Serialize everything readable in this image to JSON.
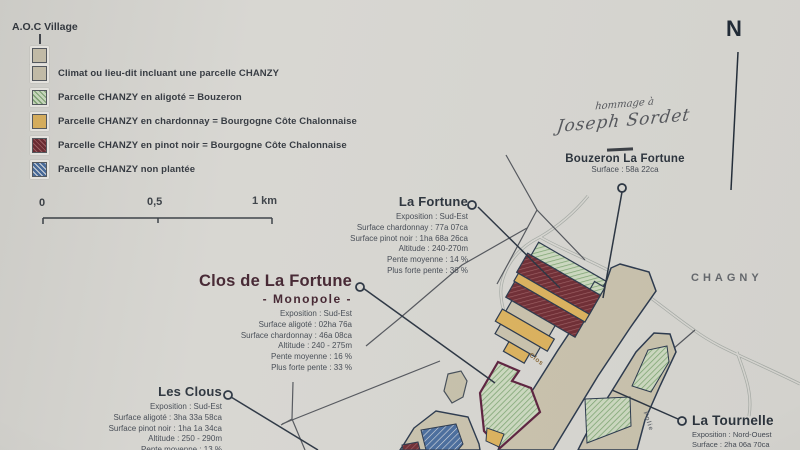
{
  "legend": {
    "aoc": "A.O.C Village",
    "items": [
      {
        "label": "Climat ou lieu-dit incluant une parcelle CHANZY",
        "swatch": "beige"
      },
      {
        "label": "Parcelle CHANZY en aligoté = Bouzeron",
        "swatch": "green-hatch"
      },
      {
        "label": "Parcelle CHANZY en chardonnay = Bourgogne Côte Chalonnaise",
        "swatch": "gold"
      },
      {
        "label": "Parcelle CHANZY en pinot noir = Bourgogne Côte Chalonnaise",
        "swatch": "maroon-hatch"
      },
      {
        "label": "Parcelle CHANZY non plantée",
        "swatch": "blue-hatch"
      }
    ]
  },
  "scale": {
    "zero": "0",
    "half": "0,5",
    "one": "1 km"
  },
  "compass": "N",
  "signature": {
    "line1": "hommage à",
    "line2": "Joseph Sordet"
  },
  "blocks": {
    "bouzeron": {
      "title": "Bouzeron La Fortune",
      "surface": "Surface : 58a 22ca"
    },
    "fortune": {
      "title": "La Fortune",
      "rows": [
        "Exposition : Sud-Est",
        "Surface chardonnay : 77a 07ca",
        "Surface pinot noir : 1ha 68a 26ca",
        "Altitude : 240-270m",
        "Pente moyenne : 14 %",
        "Plus forte pente : 36 %"
      ]
    },
    "clos": {
      "title": "Clos de La Fortune",
      "subtitle": "- Monopole -",
      "rows": [
        "Exposition : Sud-Est",
        "Surface aligoté : 02ha 76a",
        "Surface chardonnay : 46a 08ca",
        "Altitude : 240 - 275m",
        "Pente moyenne : 16 %",
        "Plus forte pente : 33 %"
      ]
    },
    "clous": {
      "title": "Les Clous",
      "rows": [
        "Exposition : Sud-Est",
        "Surface aligoté : 3ha 33a 58ca",
        "Surface pinot noir : 1ha 1a 34ca",
        "Altitude : 250 - 290m",
        "Pente moyenne : 13 %"
      ]
    },
    "tournelle": {
      "title": "La Tournelle",
      "rows": [
        "Exposition : Nord-Ouest",
        "Surface : 2ha 06a 70ca"
      ]
    }
  },
  "map_labels": {
    "town": "CHAGNY",
    "clos": "Clos",
    "folie": "Folie"
  },
  "colors": {
    "paper": "#d7d6d1",
    "beige": "#c9c2ad",
    "green": "#cdddc1",
    "gold": "#dcb25e",
    "maroon": "#6d2b32",
    "blue": "#4a6d9d",
    "outline": "#2c3a4e",
    "monopole_outline": "#5e2340"
  }
}
